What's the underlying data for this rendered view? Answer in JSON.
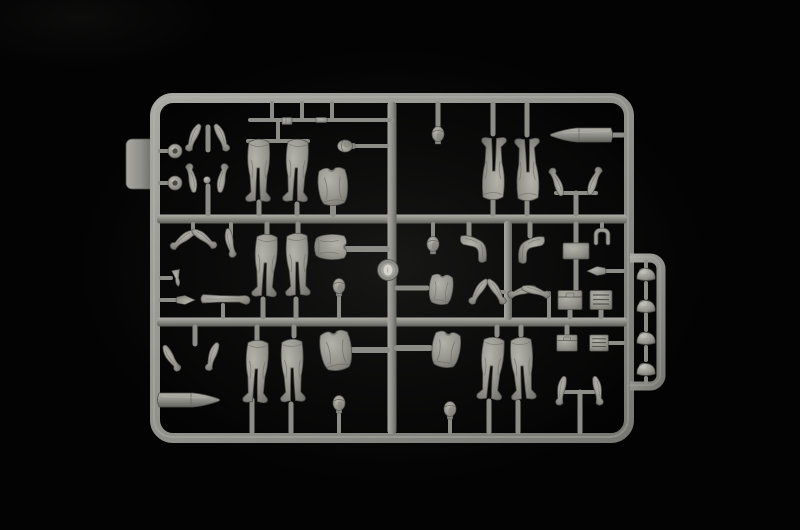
{
  "scene": {
    "subject": "photograph of a grey injection-molded model kit sprue with soldier figure parts on a black background",
    "background_color": "#030303",
    "plastic_color": "#90908a",
    "plastic_highlight": "#b2b2ab",
    "plastic_shadow": "#5e5e59",
    "canvas": {
      "width": 800,
      "height": 530
    }
  },
  "sprue": {
    "frame": {
      "x1": 155,
      "y1": 98,
      "x2": 629,
      "y2": 438,
      "r": 18,
      "w": 10
    },
    "tab": {
      "x": 126,
      "y": 139,
      "w": 30,
      "h": 50,
      "r": 6
    },
    "extension": {
      "xi": 630,
      "xo": 661,
      "yt": 258,
      "ym": 318,
      "yb": 386,
      "w": 9,
      "r": 11
    },
    "hrails": [
      {
        "x1": 157,
        "y": 219,
        "x2": 627,
        "w": 9
      },
      {
        "x1": 157,
        "y": 322,
        "x2": 627,
        "w": 9
      }
    ],
    "vrails": [
      {
        "x": 392,
        "y1": 102,
        "y2": 434,
        "w": 9
      },
      {
        "x": 508,
        "y1": 221,
        "y2": 320,
        "w": 8
      }
    ],
    "stubs": [
      [
        160,
        151,
        169,
        151,
        4
      ],
      [
        160,
        183,
        169,
        183,
        4
      ],
      [
        208,
        127,
        208,
        150,
        5
      ],
      [
        208,
        186,
        208,
        214,
        5
      ],
      [
        250,
        120,
        392,
        120,
        4
      ],
      [
        272,
        103,
        272,
        120,
        4
      ],
      [
        302,
        103,
        302,
        120,
        4
      ],
      [
        332,
        103,
        332,
        120,
        4
      ],
      [
        248,
        141,
        308,
        141,
        4
      ],
      [
        278,
        122,
        278,
        141,
        4
      ],
      [
        259,
        202,
        259,
        214,
        5
      ],
      [
        297,
        204,
        297,
        214,
        5
      ],
      [
        333,
        205,
        333,
        214,
        6
      ],
      [
        355,
        146,
        387,
        146,
        4
      ],
      [
        438,
        104,
        438,
        126,
        5
      ],
      [
        493,
        104,
        493,
        134,
        5
      ],
      [
        527,
        104,
        527,
        135,
        5
      ],
      [
        493,
        200,
        493,
        214,
        5
      ],
      [
        527,
        202,
        527,
        214,
        5
      ],
      [
        608,
        135,
        623,
        135,
        5
      ],
      [
        556,
        193,
        596,
        193,
        4
      ],
      [
        576,
        193,
        576,
        214,
        5
      ],
      [
        193,
        224,
        193,
        234,
        4
      ],
      [
        231,
        224,
        231,
        236,
        4
      ],
      [
        161,
        278,
        171,
        278,
        4
      ],
      [
        161,
        300,
        176,
        300,
        4
      ],
      [
        223,
        305,
        223,
        317,
        4
      ],
      [
        267,
        224,
        267,
        236,
        5
      ],
      [
        263,
        299,
        263,
        317,
        5
      ],
      [
        298,
        224,
        298,
        234,
        5
      ],
      [
        296,
        299,
        296,
        317,
        5
      ],
      [
        346,
        249,
        387,
        249,
        6
      ],
      [
        339,
        296,
        339,
        317,
        4
      ],
      [
        433,
        224,
        433,
        238,
        4
      ],
      [
        397,
        288,
        427,
        288,
        5
      ],
      [
        469,
        224,
        469,
        236,
        5
      ],
      [
        497,
        292,
        504,
        292,
        4
      ],
      [
        530,
        224,
        530,
        236,
        5
      ],
      [
        539,
        293,
        549,
        293,
        4
      ],
      [
        549,
        293,
        549,
        317,
        4
      ],
      [
        576,
        224,
        576,
        243,
        5
      ],
      [
        576,
        259,
        576,
        291,
        5
      ],
      [
        602,
        224,
        602,
        230,
        4
      ],
      [
        605,
        271,
        623,
        271,
        4
      ],
      [
        570,
        310,
        570,
        317,
        5
      ],
      [
        601,
        310,
        601,
        317,
        5
      ],
      [
        195,
        327,
        195,
        344,
        5
      ],
      [
        159,
        400,
        163,
        400,
        5
      ],
      [
        257,
        327,
        257,
        340,
        5
      ],
      [
        252,
        400,
        252,
        432,
        5
      ],
      [
        294,
        327,
        294,
        336,
        5
      ],
      [
        291,
        404,
        291,
        432,
        5
      ],
      [
        353,
        350,
        387,
        350,
        6
      ],
      [
        339,
        413,
        339,
        432,
        4
      ],
      [
        397,
        348,
        430,
        348,
        6
      ],
      [
        450,
        418,
        450,
        432,
        4
      ],
      [
        497,
        327,
        497,
        335,
        5
      ],
      [
        489,
        401,
        489,
        432,
        5
      ],
      [
        521,
        327,
        521,
        335,
        5
      ],
      [
        518,
        402,
        518,
        432,
        5
      ],
      [
        562,
        392,
        599,
        392,
        4
      ],
      [
        580,
        392,
        580,
        432,
        5
      ],
      [
        567,
        327,
        567,
        336,
        5
      ],
      [
        608,
        343,
        623,
        343,
        4
      ],
      [
        646,
        262,
        646,
        267,
        4
      ],
      [
        646,
        283,
        646,
        298,
        4
      ],
      [
        646,
        314,
        646,
        330,
        4
      ],
      [
        646,
        347,
        646,
        360,
        4
      ],
      [
        646,
        378,
        646,
        383,
        4
      ]
    ],
    "parts": [
      {
        "t": "canteen",
        "x": 175,
        "y": 151,
        "n": "round-canteen"
      },
      {
        "t": "canteen",
        "x": 175,
        "y": 183,
        "n": "round-canteen"
      },
      {
        "t": "arm",
        "x": 194,
        "y": 138,
        "r": 25,
        "n": "figure-arm"
      },
      {
        "t": "arm",
        "x": 221,
        "y": 138,
        "r": -25,
        "sx": -1,
        "n": "figure-arm"
      },
      {
        "t": "arm",
        "x": 191,
        "y": 178,
        "r": 170,
        "n": "figure-arm"
      },
      {
        "t": "arm",
        "x": 223,
        "y": 178,
        "r": -170,
        "sx": -1,
        "n": "figure-arm"
      },
      {
        "t": "ball",
        "x": 207,
        "y": 180,
        "n": "small-knob"
      },
      {
        "t": "rodA",
        "x": 287,
        "y": 121,
        "n": "small-fitting"
      },
      {
        "t": "rodB",
        "x": 322,
        "y": 120,
        "n": "small-fitting"
      },
      {
        "t": "legs",
        "x": 259,
        "y": 172,
        "n": "figure-legs"
      },
      {
        "t": "legs",
        "x": 297,
        "y": 172,
        "r": 2,
        "n": "figure-legs"
      },
      {
        "t": "torso",
        "x": 333,
        "y": 186,
        "r": -4,
        "n": "figure-torso"
      },
      {
        "t": "head",
        "x": 347,
        "y": 146,
        "r": -90,
        "n": "figure-head"
      },
      {
        "t": "head",
        "x": 438,
        "y": 136,
        "n": "figure-head"
      },
      {
        "t": "legs",
        "x": 493,
        "y": 167,
        "r": 180,
        "n": "figure-legs-inverted"
      },
      {
        "t": "legs",
        "x": 527,
        "y": 168,
        "r": 178,
        "n": "figure-legs-inverted"
      },
      {
        "t": "shell",
        "x": 581,
        "y": 135,
        "sx": -1,
        "n": "artillery-shell"
      },
      {
        "t": "arm",
        "x": 556,
        "y": 182,
        "r": 160,
        "n": "figure-arm"
      },
      {
        "t": "arm",
        "x": 595,
        "y": 181,
        "r": -160,
        "sx": -1,
        "n": "figure-arm"
      },
      {
        "t": "arm",
        "x": 183,
        "y": 240,
        "r": 55,
        "n": "figure-arm"
      },
      {
        "t": "arm",
        "x": 204,
        "y": 239,
        "r": -55,
        "sx": -1,
        "n": "figure-arm"
      },
      {
        "t": "arm",
        "x": 231,
        "y": 243,
        "r": -10,
        "n": "figure-arm"
      },
      {
        "t": "cone",
        "x": 177,
        "y": 278,
        "r": -10,
        "n": "small-cone-part"
      },
      {
        "t": "wedge",
        "x": 185,
        "y": 300,
        "r": 180,
        "n": "small-wedge-part"
      },
      {
        "t": "armstr",
        "x": 227,
        "y": 299,
        "n": "figure-arm-straight"
      },
      {
        "t": "legs",
        "x": 266,
        "y": 267,
        "r": 2,
        "n": "figure-legs"
      },
      {
        "t": "legs",
        "x": 298,
        "y": 266,
        "r": -2,
        "n": "figure-legs"
      },
      {
        "t": "torso",
        "x": 331,
        "y": 247,
        "r": 90,
        "s": 0.85,
        "n": "figure-torso"
      },
      {
        "t": "head",
        "x": 339,
        "y": 288,
        "n": "figure-head"
      },
      {
        "t": "disc",
        "x": 388,
        "y": 270,
        "n": "round-base-disc"
      },
      {
        "t": "head",
        "x": 433,
        "y": 246,
        "n": "figure-head"
      },
      {
        "t": "torso",
        "x": 441,
        "y": 289,
        "r": 6,
        "s": 0.8,
        "n": "figure-torso"
      },
      {
        "t": "legsbent",
        "x": 478,
        "y": 248,
        "n": "figure-legs-bent"
      },
      {
        "t": "arm",
        "x": 479,
        "y": 292,
        "r": 35,
        "n": "figure-arm"
      },
      {
        "t": "arm",
        "x": 496,
        "y": 292,
        "r": -35,
        "sx": -1,
        "n": "figure-arm"
      },
      {
        "t": "legsbent",
        "x": 527,
        "y": 249,
        "sx": -1,
        "n": "figure-legs-bent"
      },
      {
        "t": "arm",
        "x": 522,
        "y": 292,
        "r": 75,
        "n": "figure-arm"
      },
      {
        "t": "arm",
        "x": 536,
        "y": 292,
        "r": -75,
        "sx": -1,
        "n": "figure-arm"
      },
      {
        "t": "boxa",
        "x": 576,
        "y": 251,
        "n": "equipment-box"
      },
      {
        "t": "upart",
        "x": 602,
        "y": 236,
        "n": "u-shaped-part"
      },
      {
        "t": "wedge",
        "x": 597,
        "y": 271,
        "n": "small-wedge-part"
      },
      {
        "t": "boxlid",
        "x": 570,
        "y": 300,
        "n": "ammo-box"
      },
      {
        "t": "boxgrid",
        "x": 601,
        "y": 300,
        "n": "radio-box"
      },
      {
        "t": "arm",
        "x": 172,
        "y": 358,
        "r": -30,
        "n": "figure-arm"
      },
      {
        "t": "arm",
        "x": 213,
        "y": 357,
        "r": 20,
        "n": "figure-arm"
      },
      {
        "t": "shell",
        "x": 189,
        "y": 400,
        "n": "artillery-shell"
      },
      {
        "t": "legs",
        "x": 257,
        "y": 373,
        "r": 2,
        "n": "figure-legs"
      },
      {
        "t": "legs",
        "x": 293,
        "y": 372,
        "r": -2,
        "n": "figure-legs"
      },
      {
        "t": "torso",
        "x": 336,
        "y": 350,
        "r": -8,
        "s": 1.05,
        "n": "figure-torso"
      },
      {
        "t": "head",
        "x": 339,
        "y": 405,
        "n": "figure-head"
      },
      {
        "t": "torso",
        "x": 446,
        "y": 349,
        "r": 8,
        "s": 0.95,
        "n": "figure-torso"
      },
      {
        "t": "head",
        "x": 450,
        "y": 411,
        "n": "figure-head"
      },
      {
        "t": "legs",
        "x": 492,
        "y": 370,
        "r": 4,
        "n": "figure-legs"
      },
      {
        "t": "legs",
        "x": 523,
        "y": 370,
        "r": -4,
        "n": "figure-legs"
      },
      {
        "t": "arm",
        "x": 562,
        "y": 391,
        "r": 12,
        "n": "figure-arm"
      },
      {
        "t": "arm",
        "x": 597,
        "y": 391,
        "r": -12,
        "sx": -1,
        "n": "figure-arm"
      },
      {
        "t": "boxlid",
        "x": 567,
        "y": 343,
        "s": 0.85,
        "n": "ammo-box"
      },
      {
        "t": "boxgrid",
        "x": 599,
        "y": 343,
        "s": 0.85,
        "n": "radio-box"
      },
      {
        "t": "helmet",
        "x": 646,
        "y": 274,
        "n": "helmet"
      },
      {
        "t": "helmet",
        "x": 646,
        "y": 306,
        "n": "helmet"
      },
      {
        "t": "helmet",
        "x": 646,
        "y": 338,
        "n": "helmet"
      },
      {
        "t": "helmet",
        "x": 646,
        "y": 369,
        "n": "helmet"
      }
    ]
  }
}
